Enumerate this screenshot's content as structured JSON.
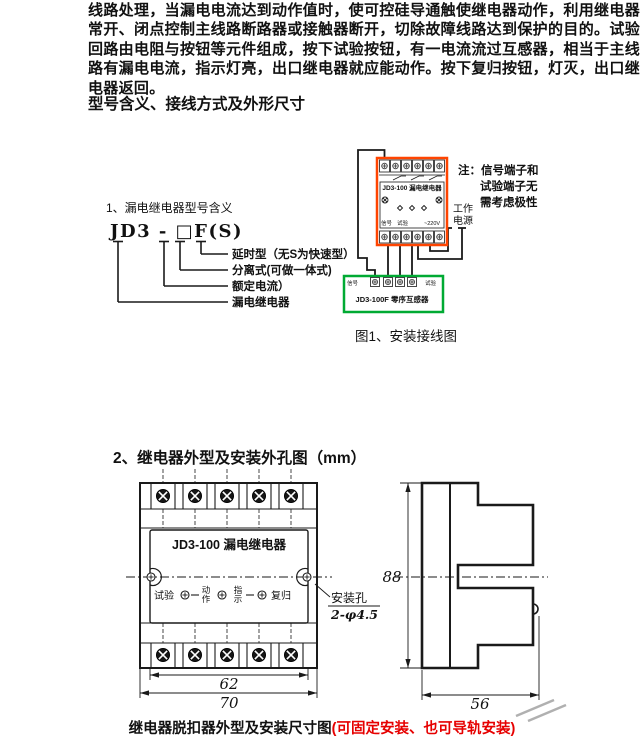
{
  "intro_paragraph": "线路处理，当漏电电流达到动作值时，使可控硅导通触使继电器动作，利用继电器常开、闭点控制主线路断路器或接触器断开，切除故障线路达到保护的目的。试验回路由电阻与按钮等元件组成，按下试验按钮，有一电流流过互感器，相当于主线路有漏电电流，指示灯亮，出口继电器就应能动作。按下复归按钮，灯灭，出口继电器返回。",
  "section1_heading": "型号含义、接线方式及外形尺寸",
  "model_meaning": {
    "title": "1、漏电继电器型号含义",
    "code": "JD3 - □F(S)",
    "labels": [
      "延时型（无S为快速型）",
      "分离式(可做一体式)",
      "额定电流）",
      "漏电继电器"
    ]
  },
  "wiring": {
    "relay_title": "JD3-100 漏电继电器",
    "relay_signal": "信号",
    "relay_test": "试验",
    "relay_voltage": "~220V",
    "note_line1": "注：信号端子和",
    "note_line2": "试验端子无",
    "note_line3": "需考虑极性",
    "power_line1": "工作",
    "power_line2": "电源",
    "ct_signal": "信号",
    "ct_test": "试验",
    "ct_title": "JD3-100F 零序互感器",
    "caption": "图1、安装接线图"
  },
  "section2_heading": "2、继电器外型及安装外孔图（mm）",
  "outline": {
    "device_title": "JD3-100 漏电继电器",
    "label_test": "试验",
    "action_char1": "动",
    "action_char2": "作",
    "indicate_char1": "指",
    "indicate_char2": "示",
    "label_reset": "复归",
    "mount_hole_line1": "安装孔",
    "mount_hole_line2": "2-φ4.5",
    "dim_inner_width": "62",
    "dim_outer_width": "70",
    "dim_height": "88",
    "dim_depth": "56"
  },
  "bottom_caption": {
    "main": "继电器脱扣器外型及安装尺寸图",
    "red": "(可固定安装、也可导轨安装)"
  },
  "colors": {
    "relay_border": "#ff4400",
    "ct_border": "#00aa33",
    "caption_red": "#e60000"
  }
}
